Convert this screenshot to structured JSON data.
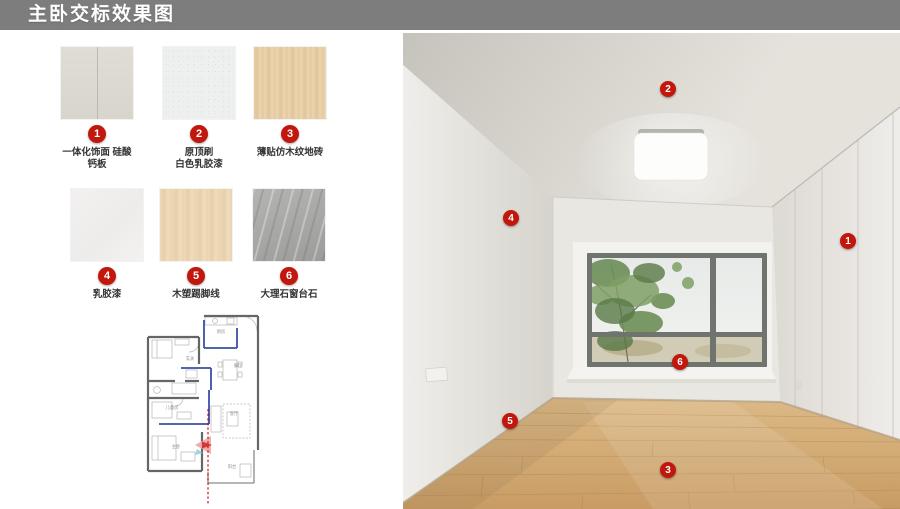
{
  "title": "主卧交标效果图",
  "colors": {
    "badge_red": "#c2170d",
    "title_bar_gray": "#7d7d7d"
  },
  "materials": [
    {
      "num": "1",
      "label": "一体化饰面 硅酸\n钙板"
    },
    {
      "num": "2",
      "label": "原顶刷\n白色乳胶漆"
    },
    {
      "num": "3",
      "label": "薄贴仿木纹地砖"
    },
    {
      "num": "4",
      "label": "乳胶漆"
    },
    {
      "num": "5",
      "label": "木塑踢脚线"
    },
    {
      "num": "6",
      "label": "大理石窗台石"
    }
  ],
  "floorplan": {
    "rooms": [
      {
        "name": "厨房"
      },
      {
        "name": "玄关"
      },
      {
        "name": "餐厅"
      },
      {
        "name": "儿童房"
      },
      {
        "name": "客厅"
      },
      {
        "name": "主卧"
      },
      {
        "name": "阳台"
      }
    ]
  },
  "render": {
    "callouts": [
      {
        "num": "2"
      },
      {
        "num": "4"
      },
      {
        "num": "1"
      },
      {
        "num": "6"
      },
      {
        "num": "5"
      },
      {
        "num": "3"
      }
    ]
  }
}
